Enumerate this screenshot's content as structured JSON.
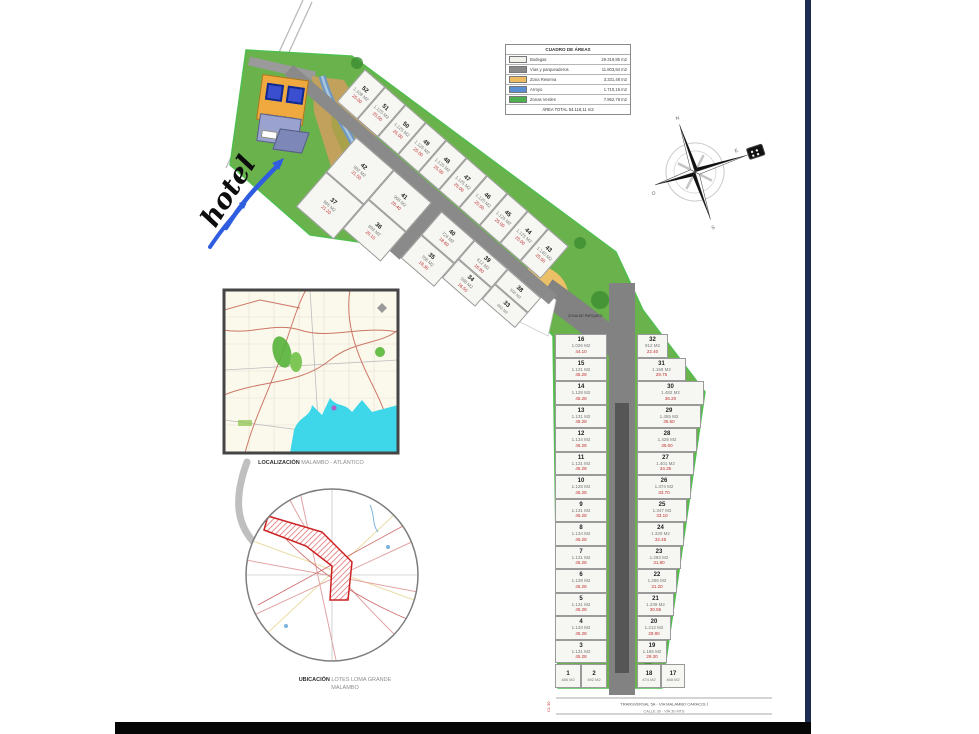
{
  "legend": {
    "title": "CUADRO DE ÁREAS",
    "rows": [
      {
        "label": "Bodegas",
        "value": "29.319,85 m2",
        "color": "#f2f2ec"
      },
      {
        "label": "Vías y parqueaderos",
        "value": "11.803,84 m2",
        "color": "#8a8a8a"
      },
      {
        "label": "Zona Reserva",
        "value": "3.331,48 m2",
        "color": "#f0bc62"
      },
      {
        "label": "Arroyo",
        "value": "1.710,16 m2",
        "color": "#5b8fd4"
      },
      {
        "label": "Zonas Verdes",
        "value": "7.952,78 m2",
        "color": "#4caf50"
      }
    ],
    "footer": "ÁREA TOTAL  54.118,11 m2"
  },
  "labels": {
    "hotel": "hotel",
    "arroyo": "Arroyo",
    "parqueo": "ZONA DE PARQUEO",
    "servicio": "ÁREA DE SERVICIO",
    "via": "VÍA",
    "road_dim": "225.00"
  },
  "maps": {
    "localizacion": {
      "bold": "LOCALIZACIÓN",
      "rest": " MALAMBO - ATLÁNTICO"
    },
    "ubicacion": {
      "bold": "UBICACIÓN",
      "rest": " LOTES LOMA GRANDE",
      "line2": "MALAMBO"
    }
  },
  "compass": {
    "n": "N",
    "s": "S",
    "e": "E",
    "o": "O"
  },
  "streets": {
    "line1": "TRANSVERSAL 5A - VÍA MALAMBO CARACOLÍ",
    "line2": "CALLE 30 - VÍA 30 MTS",
    "side": "CL 30"
  },
  "lots": {
    "strip_top": [
      {
        "n": "52",
        "a": "1.108 M2",
        "d": "25.00"
      },
      {
        "n": "51",
        "a": "1.125 M2",
        "d": "25.00"
      },
      {
        "n": "50",
        "a": "1.125 M2",
        "d": "25.00"
      },
      {
        "n": "49",
        "a": "1.125 M2",
        "d": "25.00"
      },
      {
        "n": "48",
        "a": "1.125 M2",
        "d": "25.00"
      },
      {
        "n": "47",
        "a": "1.125 M2",
        "d": "25.00"
      },
      {
        "n": "46",
        "a": "1.125 M2",
        "d": "25.00"
      },
      {
        "n": "45",
        "a": "1.125 M2",
        "d": "25.00"
      },
      {
        "n": "44",
        "a": "1.125 M2",
        "d": "25.00"
      },
      {
        "n": "43",
        "a": "1.140 M2",
        "d": "25.00"
      }
    ],
    "band_cols": [
      {
        "top": {
          "n": "42",
          "a": "982 M2",
          "d": "21.50"
        },
        "bottom": {
          "n": "37",
          "a": "965 M2",
          "d": "21.20"
        }
      },
      {
        "top": {
          "n": "41",
          "a": "908 M2",
          "d": "20.40"
        },
        "bottom": {
          "n": "36",
          "a": "893 M2",
          "d": "20.10"
        }
      },
      {
        "top": {
          "n": "40",
          "a": "724 M2",
          "d": "18.60"
        },
        "bottom": {
          "n": "35",
          "a": "708 M2",
          "d": "18.30"
        }
      },
      {
        "top": {
          "n": "39",
          "a": "612 M2",
          "d": "16.80"
        },
        "bottom": {
          "n": "34",
          "a": "598 M2",
          "d": "16.50"
        }
      },
      {
        "top": {
          "n": "38",
          "a": "506 M2",
          "d": "14.90"
        },
        "bottom": {
          "n": "33",
          "a": "492 M2",
          "d": "14.60"
        }
      }
    ],
    "col_left": [
      {
        "n": "16",
        "a": "1.026 M2",
        "d": "44.10"
      },
      {
        "n": "15",
        "a": "1.131 M2",
        "d": "45.28"
      },
      {
        "n": "14",
        "a": "1.128 M2",
        "d": "45.28"
      },
      {
        "n": "13",
        "a": "1.131 M2",
        "d": "45.28"
      },
      {
        "n": "12",
        "a": "1.134 M2",
        "d": "45.28"
      },
      {
        "n": "11",
        "a": "1.131 M2",
        "d": "45.28"
      },
      {
        "n": "10",
        "a": "1.128 M2",
        "d": "45.28"
      },
      {
        "n": "9",
        "a": "1.131 M2",
        "d": "45.28"
      },
      {
        "n": "8",
        "a": "1.134 M2",
        "d": "45.28"
      },
      {
        "n": "7",
        "a": "1.131 M2",
        "d": "45.28"
      },
      {
        "n": "6",
        "a": "1.128 M2",
        "d": "45.28"
      },
      {
        "n": "5",
        "a": "1.131 M2",
        "d": "45.28"
      },
      {
        "n": "4",
        "a": "1.134 M2",
        "d": "45.28"
      },
      {
        "n": "3",
        "a": "1.131 M2",
        "d": "45.28"
      }
    ],
    "col_right": [
      {
        "n": "32",
        "a": "912 M2",
        "d": "22.40"
      },
      {
        "n": "31",
        "a": "1.168 M2",
        "d": "28.75"
      },
      {
        "n": "30",
        "a": "1.482 M2",
        "d": "36.20"
      },
      {
        "n": "29",
        "a": "1.455 M2",
        "d": "35.60"
      },
      {
        "n": "28",
        "a": "1.428 M2",
        "d": "35.00"
      },
      {
        "n": "27",
        "a": "1.401 M2",
        "d": "34.35"
      },
      {
        "n": "26",
        "a": "1.374 M2",
        "d": "33.70"
      },
      {
        "n": "25",
        "a": "1.347 M2",
        "d": "33.10"
      },
      {
        "n": "24",
        "a": "1.320 M2",
        "d": "32.45"
      },
      {
        "n": "23",
        "a": "1.293 M2",
        "d": "31.80"
      },
      {
        "n": "22",
        "a": "1.266 M2",
        "d": "31.20"
      },
      {
        "n": "21",
        "a": "1.239 M2",
        "d": "30.55"
      },
      {
        "n": "20",
        "a": "1.212 M2",
        "d": "29.90"
      },
      {
        "n": "19",
        "a": "1.185 M2",
        "d": "29.30"
      }
    ],
    "bottom_left": [
      {
        "n": "1",
        "a": "486 M2",
        "d": "18.00"
      },
      {
        "n": "2",
        "a": "492 M2",
        "d": "18.20"
      }
    ],
    "bottom_right": [
      {
        "n": "18",
        "a": "474 M2",
        "d": "17.60"
      },
      {
        "n": "17",
        "a": "468 M2",
        "d": "17.40"
      }
    ]
  }
}
